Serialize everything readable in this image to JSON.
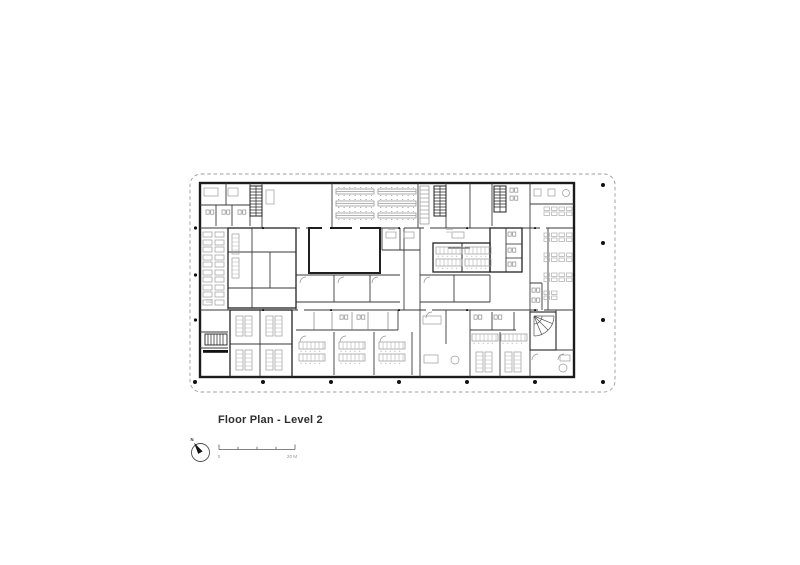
{
  "drawing": {
    "title": "Floor Plan - Level 2",
    "north": {
      "label": "N"
    },
    "scale_bar": {
      "start": "0",
      "end": "20 M"
    },
    "colors": {
      "background": "#ffffff",
      "building_wall": "#1b1b1b",
      "partition_wall": "#3a3a3a",
      "furniture": "#a0a0a0",
      "property_boundary": "#9c9c9c",
      "column_dot": "#111111",
      "title_text": "#2e2e2e",
      "scale_text": "#939393"
    }
  }
}
